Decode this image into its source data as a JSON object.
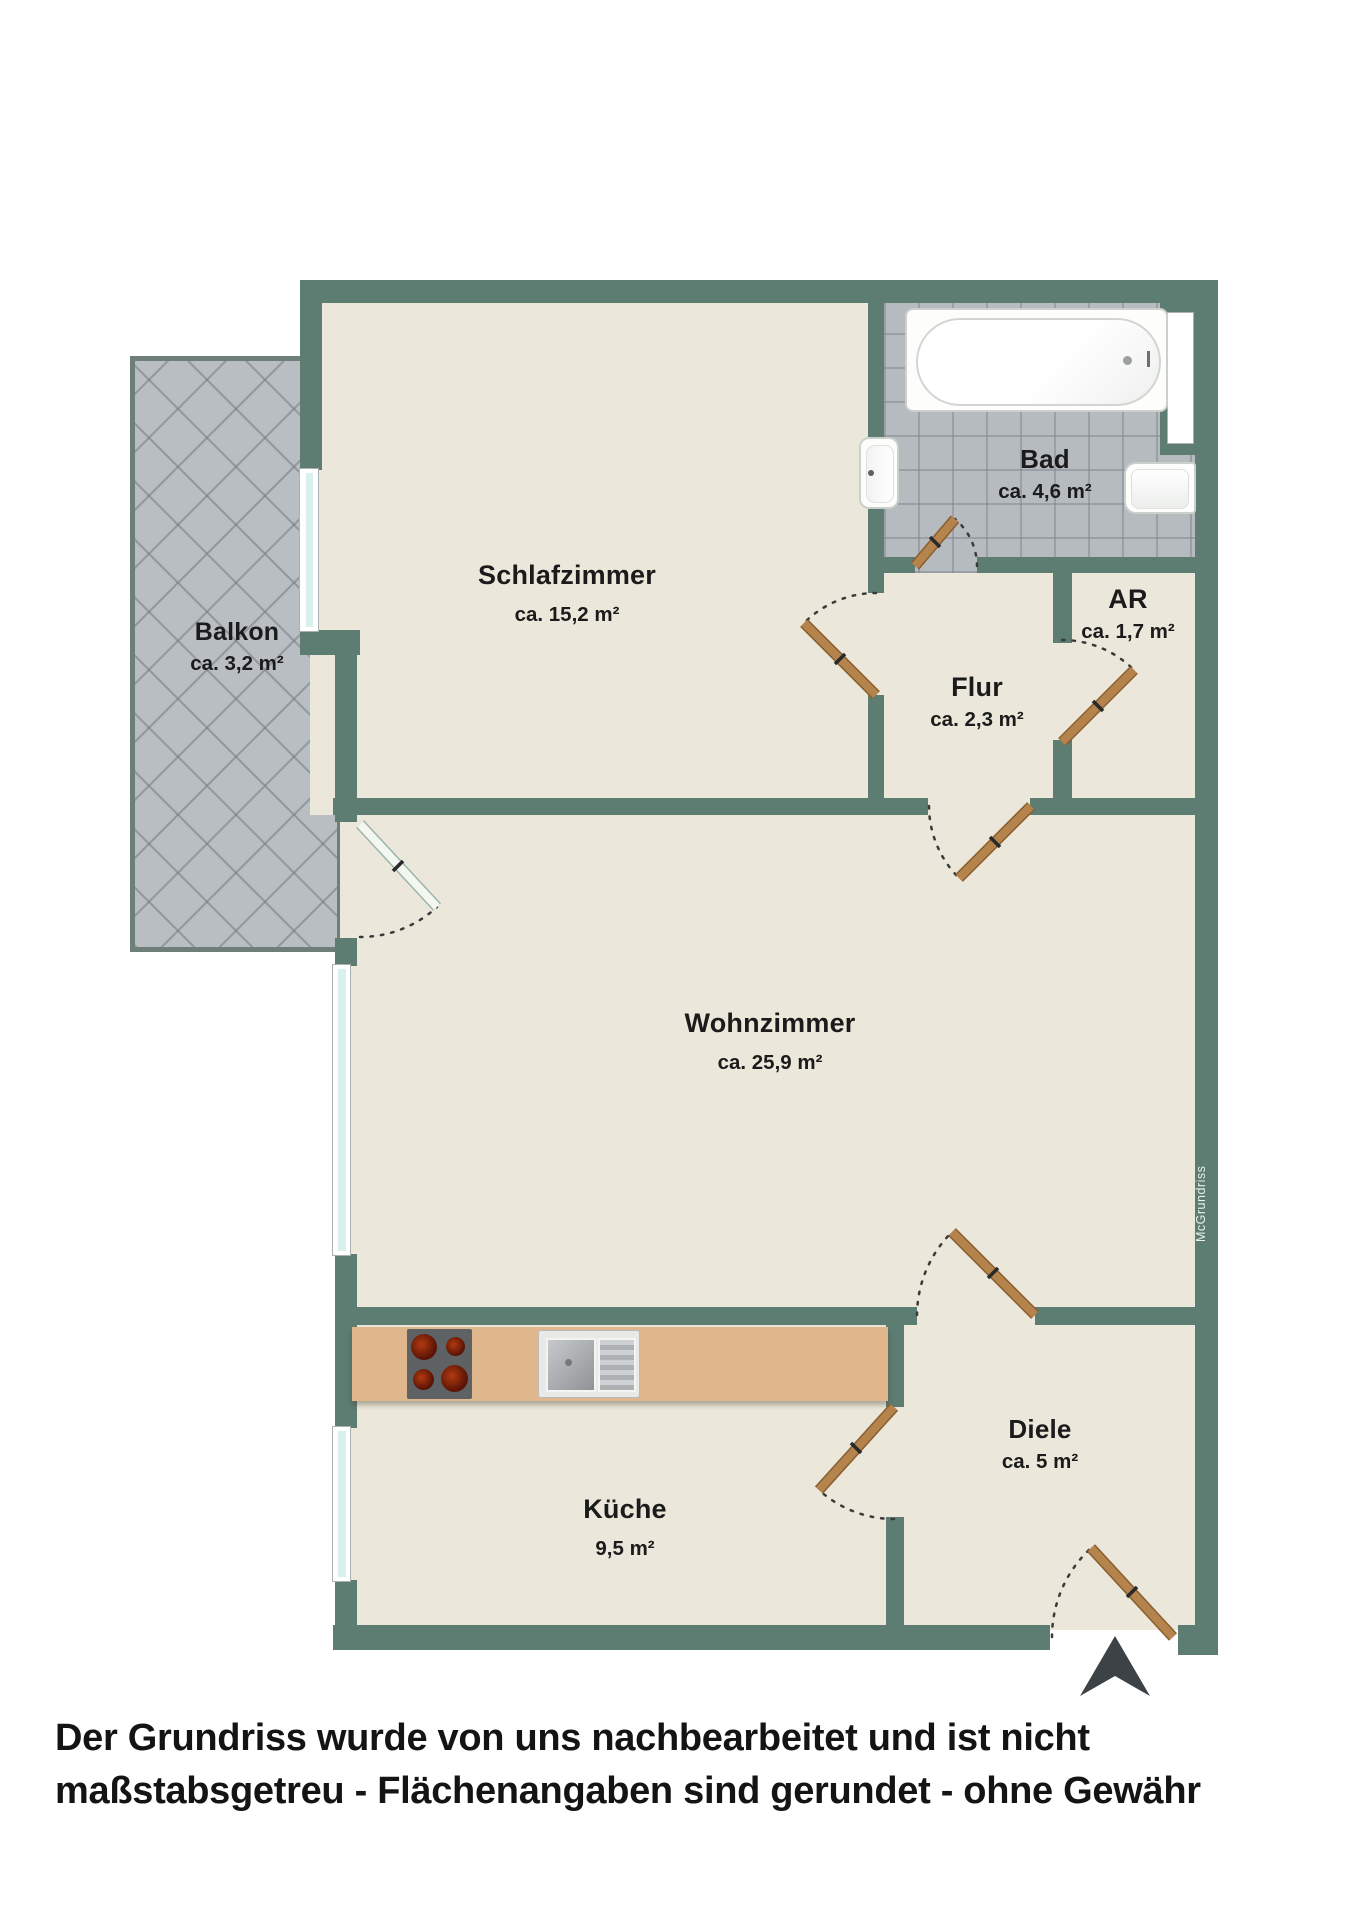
{
  "rooms": {
    "schlafzimmer": {
      "name": "Schlafzimmer",
      "area": "ca. 15,2 m²"
    },
    "bad": {
      "name": "Bad",
      "area": "ca. 4,6 m²"
    },
    "ar": {
      "name": "AR",
      "area": "ca. 1,7 m²"
    },
    "flur": {
      "name": "Flur",
      "area": "ca. 2,3 m²"
    },
    "wohnzimmer": {
      "name": "Wohnzimmer",
      "area": "ca. 25,9 m²"
    },
    "balkon": {
      "name": "Balkon",
      "area": "ca. 3,2 m²"
    },
    "kueche": {
      "name": "Küche",
      "area": "9,5 m²"
    },
    "diele": {
      "name": "Diele",
      "area": "ca. 5 m²"
    }
  },
  "watermark": "McGrundriss",
  "disclaimer": {
    "line1": "Der Grundriss wurde von uns nachbearbeitet und ist nicht",
    "line2": "maßstabsgetreu - Flächenangaben sind gerundet - ohne Gewähr"
  },
  "colors": {
    "wall": "#5D7C72",
    "floor": "#EBE7DA",
    "tile_grey": "#B6BBC0",
    "counter_tan": "#E0B68C",
    "door_wood": "#B5834C",
    "window_glass": "#D8F1EF",
    "arrow_dark": "#3C4245"
  }
}
